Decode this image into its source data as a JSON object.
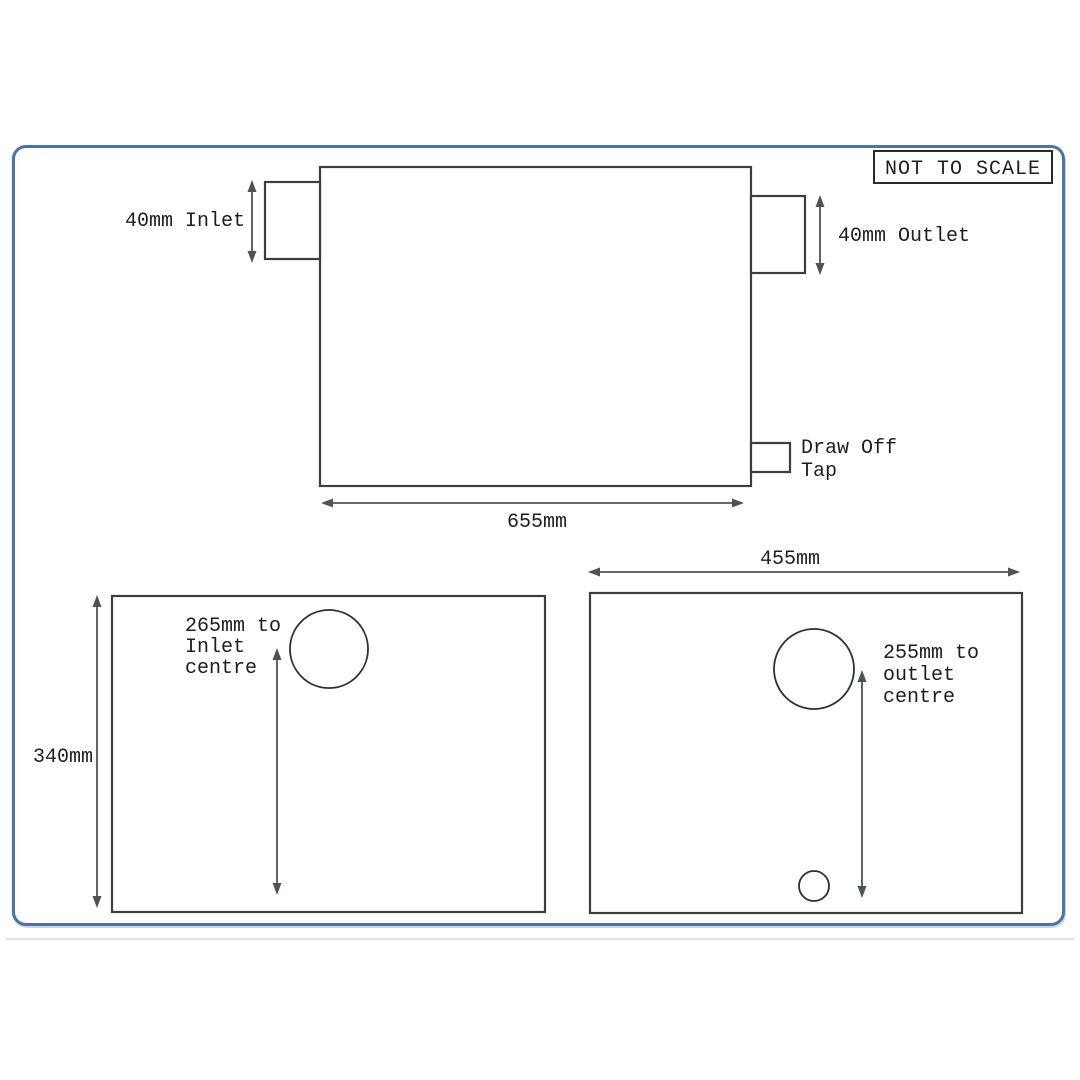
{
  "badge": {
    "label": "NOT TO SCALE"
  },
  "side_view": {
    "inlet_label": "40mm Inlet",
    "outlet_label": "40mm Outlet",
    "tap_label": [
      "Draw Off",
      "Tap"
    ],
    "width_label": "655mm"
  },
  "base_left": {
    "height_label": "340mm",
    "hole_label": [
      "265mm to",
      "Inlet",
      "centre"
    ]
  },
  "base_right": {
    "width_label": "455mm",
    "hole_label": [
      "255mm to",
      "outlet",
      "centre"
    ]
  },
  "colors": {
    "frame": "#4e73ab",
    "line": "#3d3d3d",
    "arrow": "#4f5358",
    "text": "#1d1d1d"
  }
}
